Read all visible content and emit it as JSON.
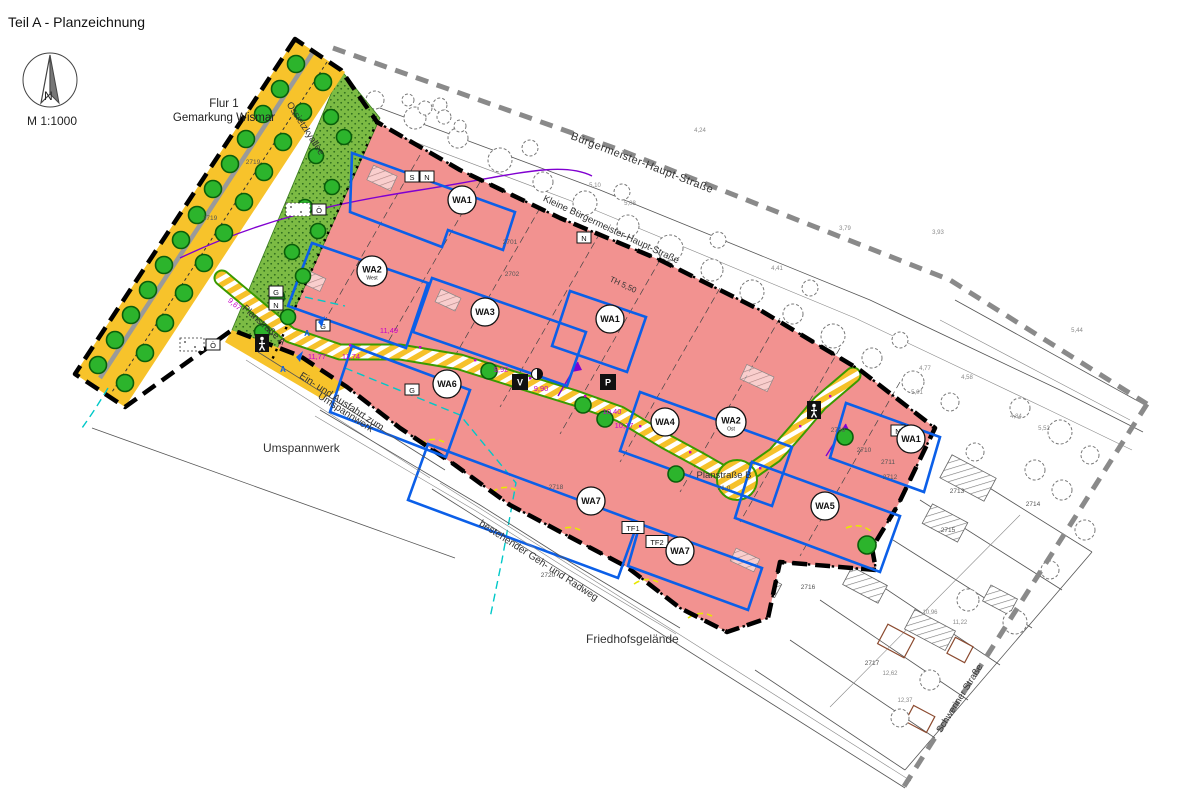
{
  "title": "Teil A - Planzeichnung",
  "compass": {
    "letter": "N",
    "scale": "M 1:1000"
  },
  "area": {
    "flur": "Flur 1",
    "gemarkung": "Gemarkung Wismar"
  },
  "streets": {
    "buergermeister": "Bürgermeister-Haupt-Straße",
    "kleine_buergermeister": "Kleine Bürgermeister-Haupt-Straße",
    "ossietzkyallee": "Ossietzkyallee",
    "schweriner": "Schweriner Straße",
    "planstrasse_a": "Planstraße A",
    "planstrasse_b": "Planstraße B",
    "planstrasse_b_width": "21,0"
  },
  "labels": {
    "umspannwerk": "Umspannwerk",
    "einfahrt_line1": "Ein- und Ausfahrt zum",
    "einfahrt_line2": "Umspannwerk",
    "friedhof": "Friedhofsgelände",
    "radweg": "bestehender Geh- und Radweg",
    "traufhoehe": "TH 5,50"
  },
  "zones": [
    {
      "label": "WA1",
      "sub": ""
    },
    {
      "label": "WA2",
      "sub": "West"
    },
    {
      "label": "WA3",
      "sub": ""
    },
    {
      "label": "WA1",
      "sub": ""
    },
    {
      "label": "WA6",
      "sub": ""
    },
    {
      "label": "WA4",
      "sub": ""
    },
    {
      "label": "WA2",
      "sub": "Ost"
    },
    {
      "label": "WA1",
      "sub": ""
    },
    {
      "label": "WA7",
      "sub": ""
    },
    {
      "label": "WA5",
      "sub": ""
    },
    {
      "label": "WA7",
      "sub": ""
    }
  ],
  "marker_boxes": [
    {
      "label": "S"
    },
    {
      "label": "N"
    },
    {
      "label": "N"
    },
    {
      "label": "Ö"
    },
    {
      "label": "Ö"
    },
    {
      "label": "G"
    },
    {
      "label": "N"
    },
    {
      "label": "G"
    },
    {
      "label": "G"
    },
    {
      "label": "N"
    },
    {
      "label": "TF1"
    },
    {
      "label": "TF2"
    }
  ],
  "road_symbols": {
    "verkehr": "V",
    "parken": "P"
  },
  "arrows": [
    "A",
    "A"
  ],
  "street_levels": [
    "9,67",
    "9,92",
    "9,90",
    "10,40",
    "10,17",
    "11,49",
    "11,77",
    "11,74"
  ],
  "parcel_numbers": [
    "2719",
    "2719",
    "2701",
    "2702",
    "2718",
    "2709",
    "2710",
    "2711",
    "2712",
    "2713",
    "2714",
    "2715",
    "2716",
    "2717",
    "2720"
  ],
  "elevations": [
    "4,24",
    "3,79",
    "3,93",
    "5,10",
    "5,08",
    "4,41",
    "4,77",
    "4,58",
    "5,01",
    "4,84",
    "5,52",
    "5,44",
    "10,96",
    "11,22",
    "12,62",
    "12,37"
  ],
  "colors": {
    "zone_pink": "#F29290",
    "road_orange": "#F7C32B",
    "green_area": "#7CBB44",
    "tree_green": "#2CB42C",
    "baugrenze_blue": "#0B5FE8",
    "road_gray": "#8A8A8A",
    "level_magenta": "#C800C8",
    "utility_cyan": "#00C8C8"
  }
}
